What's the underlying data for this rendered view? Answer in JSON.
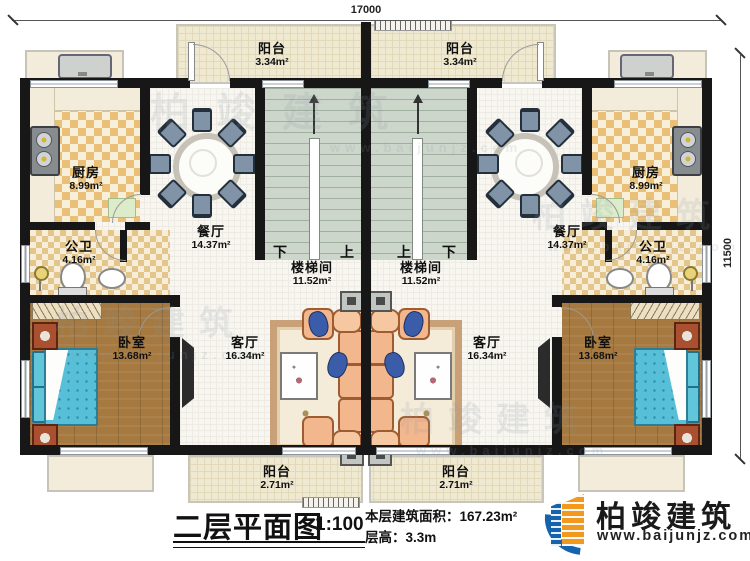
{
  "dimensions": {
    "top": "17000",
    "right": "11500"
  },
  "rooms": {
    "balcony_top": {
      "name": "阳台",
      "area": "3.34m²"
    },
    "kitchen": {
      "name": "厨房",
      "area": "8.99m²"
    },
    "dining": {
      "name": "餐厅",
      "area": "14.37m²"
    },
    "bath": {
      "name": "公卫",
      "area": "4.16m²"
    },
    "stair": {
      "name": "楼梯间",
      "area": "11.52m²",
      "down": "下",
      "up": "上"
    },
    "living": {
      "name": "客厅",
      "area": "16.34m²"
    },
    "bedroom": {
      "name": "卧室",
      "area": "13.68m²"
    },
    "balcony_bottom": {
      "name": "阳台",
      "area": "2.71m²"
    }
  },
  "title_block": {
    "title": "二层平面图",
    "scale": "1:100",
    "area_label": "本层建筑面积：",
    "area_value": "167.23m²",
    "floor_height_label": "层高：",
    "floor_height_value": "3.3m"
  },
  "brand": {
    "name": "柏竣建筑",
    "url": "www.baijunjz.com"
  },
  "watermark": {
    "name": "柏竣建筑",
    "url": "www.baijunjz.com"
  }
}
